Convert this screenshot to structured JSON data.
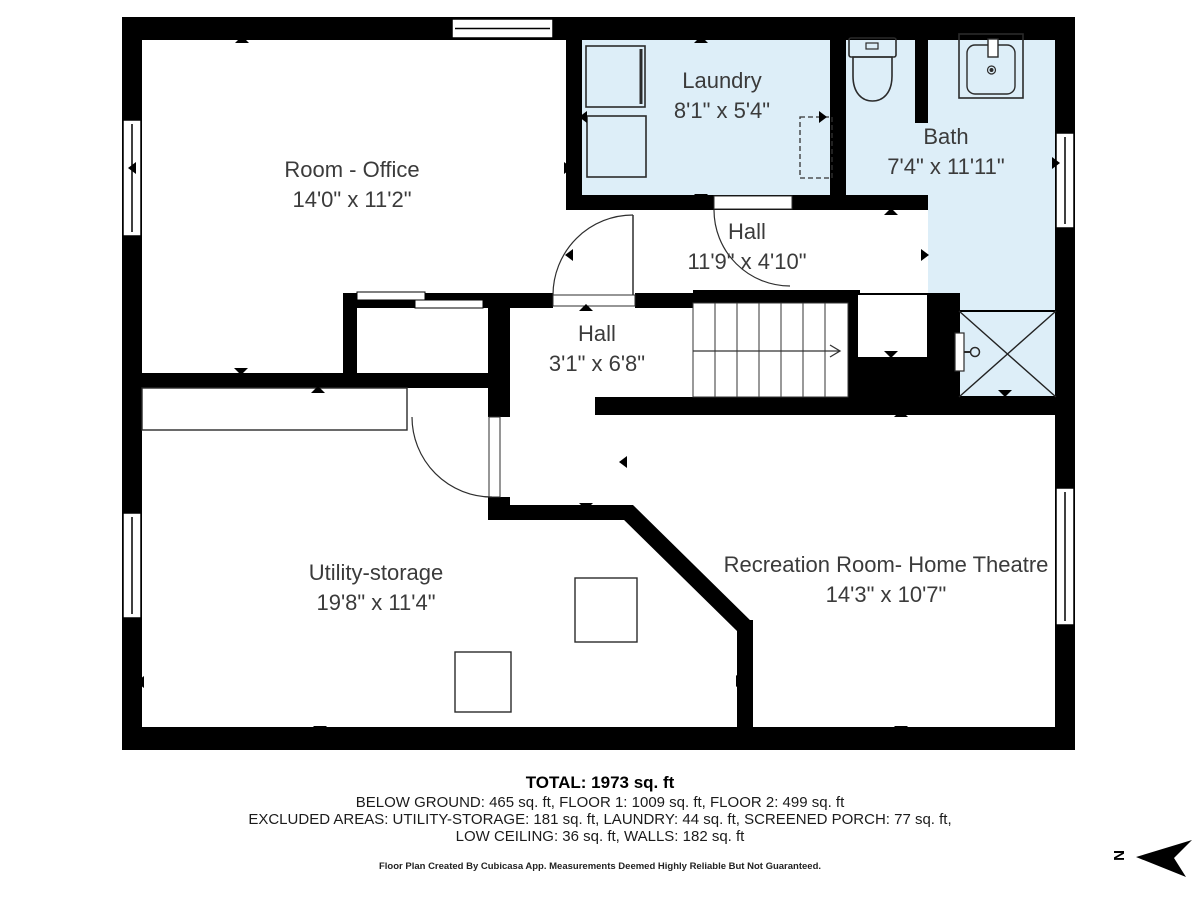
{
  "plan": {
    "rooms": [
      {
        "name": "Room - Office",
        "dims": "14'0\" x 11'2\""
      },
      {
        "name": "Laundry",
        "dims": "8'1\" x 5'4\""
      },
      {
        "name": "Bath",
        "dims": "7'4\" x 11'11\""
      },
      {
        "name": "Hall",
        "dims": "11'9\" x 4'10\""
      },
      {
        "name": "Hall",
        "dims": "3'1\" x 6'8\""
      },
      {
        "name": "Utility-storage",
        "dims": "19'8\" x 11'4\""
      },
      {
        "name": "Recreation Room- Home Theatre",
        "dims": "14'3\" x 10'7\""
      }
    ],
    "fixtures": [
      "washer-icon",
      "dryer-icon",
      "toilet-icon",
      "sink-icon",
      "shower-icon"
    ],
    "compass": {
      "label": "N"
    },
    "colors": {
      "wall": "#000000",
      "wet_room_fill": "#ddeef8",
      "line": "#2e2e2e"
    }
  },
  "footer": {
    "total": "TOTAL: 1973 sq. ft",
    "floors": "BELOW GROUND: 465 sq. ft, FLOOR 1: 1009 sq. ft, FLOOR 2: 499 sq. ft",
    "excluded1": "EXCLUDED AREAS: UTILITY-STORAGE: 181 sq. ft, LAUNDRY: 44 sq. ft, SCREENED PORCH: 77 sq. ft,",
    "excluded2": "LOW CEILING: 36 sq. ft, WALLS: 182 sq. ft",
    "disclaimer": "Floor Plan Created By Cubicasa App. Measurements Deemed Highly Reliable But Not Guaranteed."
  }
}
